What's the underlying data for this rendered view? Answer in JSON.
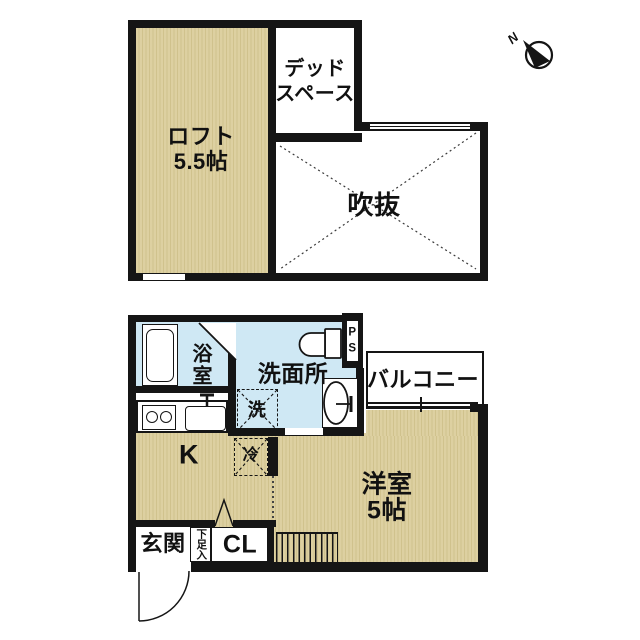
{
  "colors": {
    "room_fill": "#ddd0a1",
    "room_fill_stripe": "#d0c28d",
    "wet_area_fill": "#cfe8f4",
    "wall": "#151515",
    "background": "#ffffff"
  },
  "compass": {
    "north": "N"
  },
  "upper_floor": {
    "loft": {
      "label": "ロフト",
      "size": "5.5帖"
    },
    "dead_space": {
      "label_line1": "デッド",
      "label_line2": "スペース"
    },
    "atrium": {
      "label": "吹抜"
    }
  },
  "lower_floor": {
    "bathroom": {
      "label": "浴室"
    },
    "washroom": {
      "label": "洗面所"
    },
    "washing_machine": {
      "label": "洗"
    },
    "kitchen": {
      "label": "K"
    },
    "refrigerator": {
      "label": "冷"
    },
    "pipe_space": {
      "letter_top": "P",
      "letter_bottom": "S"
    },
    "balcony": {
      "label": "バルコニー"
    },
    "western_room": {
      "label": "洋室",
      "size": "5帖"
    },
    "entrance": {
      "label": "玄関"
    },
    "shoe_cabinet": {
      "label": "下足入"
    },
    "closet": {
      "label": "CL"
    }
  }
}
